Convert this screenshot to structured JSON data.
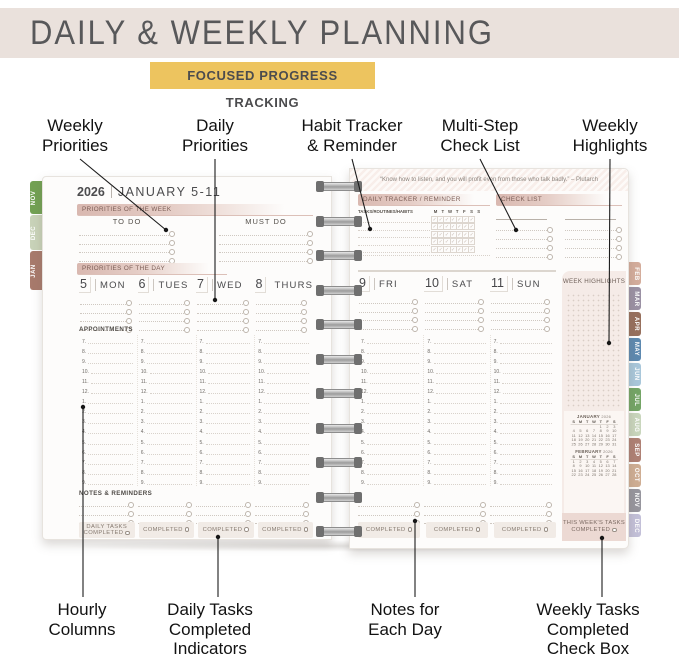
{
  "header": {
    "title": "DAILY & WEEKLY PLANNING",
    "badge": "FOCUSED PROGRESS TRACKING"
  },
  "annotations": {
    "top": [
      {
        "lines": [
          "Weekly",
          "Priorities"
        ]
      },
      {
        "lines": [
          "Daily",
          "Priorities"
        ]
      },
      {
        "lines": [
          "Habit Tracker",
          "& Reminder"
        ]
      },
      {
        "lines": [
          "Multi-Step",
          "Check List"
        ]
      },
      {
        "lines": [
          "Weekly",
          "Highlights"
        ]
      }
    ],
    "bottom": [
      {
        "lines": [
          "Hourly",
          "Columns"
        ]
      },
      {
        "lines": [
          "Daily Tasks",
          "Completed",
          "Indicators"
        ]
      },
      {
        "lines": [
          "Notes for",
          "Each Day"
        ]
      },
      {
        "lines": [
          "Weekly Tasks",
          "Completed",
          "Check Box"
        ]
      }
    ]
  },
  "hours": [
    "7",
    "8",
    "9",
    "10",
    "11",
    "12",
    "1",
    "2",
    "3",
    "4",
    "5",
    "6",
    "7",
    "8",
    "9"
  ],
  "left_page": {
    "year": "2026",
    "date_range": "JANUARY 5-11",
    "priorities_week_label": "PRIORITIES OF THE WEEK",
    "todo_label": "TO DO",
    "mustdo_label": "MUST DO",
    "priorities_day_label": "PRIORITIES OF THE DAY",
    "days": [
      {
        "num": "5",
        "name": "MON"
      },
      {
        "num": "6",
        "name": "TUES"
      },
      {
        "num": "7",
        "name": "WED"
      },
      {
        "num": "8",
        "name": "THURS"
      }
    ],
    "appointments_label": "APPOINTMENTS",
    "notes_label": "NOTES & REMINDERS",
    "daily_tasks_label_line1": "DAILY TASKS",
    "daily_tasks_label_line2": "COMPLETED",
    "completed_label": "COMPLETED",
    "tabs": [
      {
        "label": "NOV",
        "color": "#72a153"
      },
      {
        "label": "DEC",
        "color": "#c9d3b9"
      },
      {
        "label": "JAN",
        "color": "#a87a6c"
      }
    ]
  },
  "right_page": {
    "quote": "“Know how to listen, and you will profit even from those who talk badly.” – Plutarch",
    "tracker_label": "DAILY TRACKER / REMINDER",
    "tracker_header": "TASKS/ROUTINES/HABITS",
    "weekday_initials": [
      "M",
      "T",
      "W",
      "T",
      "F",
      "S",
      "S"
    ],
    "checklist_label": "CHECK LIST",
    "days": [
      {
        "num": "9",
        "name": "FRI"
      },
      {
        "num": "10",
        "name": "SAT"
      },
      {
        "num": "11",
        "name": "SUN"
      }
    ],
    "week_highlights_label": "WEEK HIGHLIGHTS",
    "this_weeks_tasks_label": "THIS WEEK'S TASKS",
    "completed_label": "COMPLETED",
    "tabs": [
      {
        "label": "FEB",
        "color": "#d4ad9c"
      },
      {
        "label": "MAR",
        "color": "#9b91a4"
      },
      {
        "label": "APR",
        "color": "#97705d"
      },
      {
        "label": "MAY",
        "color": "#5d89b0"
      },
      {
        "label": "JUN",
        "color": "#a9c7da"
      },
      {
        "label": "JUL",
        "color": "#74a566"
      },
      {
        "label": "AUG",
        "color": "#c9d6bd"
      },
      {
        "label": "SEP",
        "color": "#af8175"
      },
      {
        "label": "OCT",
        "color": "#cfae94"
      },
      {
        "label": "NOV",
        "color": "#97969e"
      },
      {
        "label": "DEC",
        "color": "#c3c0d8"
      }
    ],
    "calendars": [
      {
        "title": "JANUARY",
        "year": "2026",
        "day_headers": [
          "S",
          "M",
          "T",
          "W",
          "T",
          "F",
          "S"
        ],
        "weeks": [
          [
            "",
            "",
            "",
            "",
            "1",
            "2",
            "3"
          ],
          [
            "4",
            "5",
            "6",
            "7",
            "8",
            "9",
            "10"
          ],
          [
            "11",
            "12",
            "13",
            "14",
            "15",
            "16",
            "17"
          ],
          [
            "18",
            "19",
            "20",
            "21",
            "22",
            "23",
            "24"
          ],
          [
            "25",
            "26",
            "27",
            "28",
            "29",
            "30",
            "31"
          ]
        ]
      },
      {
        "title": "FEBRUARY",
        "year": "2026",
        "day_headers": [
          "S",
          "M",
          "T",
          "W",
          "T",
          "F",
          "S"
        ],
        "weeks": [
          [
            "1",
            "2",
            "3",
            "4",
            "5",
            "6",
            "7"
          ],
          [
            "8",
            "9",
            "10",
            "11",
            "12",
            "13",
            "14"
          ],
          [
            "15",
            "16",
            "17",
            "18",
            "19",
            "20",
            "21"
          ],
          [
            "22",
            "23",
            "24",
            "25",
            "26",
            "27",
            "28"
          ]
        ]
      }
    ]
  }
}
